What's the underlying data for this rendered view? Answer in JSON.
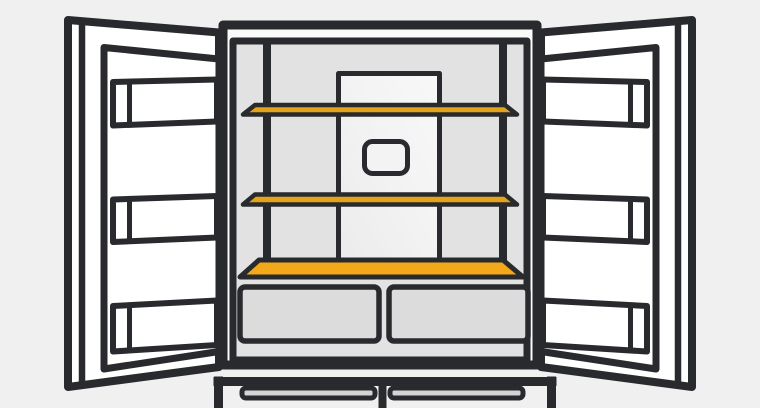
{
  "illustration": {
    "subject": "open-french-door-refrigerator",
    "style": "flat-line-art",
    "text": [],
    "highlighted_parts": [
      "upper-shelf",
      "middle-shelf",
      "bottom-deck"
    ],
    "colors": {
      "background": "#f0f0f1",
      "outline": "#292a2d",
      "door_white": "#ffffff",
      "cabinet_frame": "#fbfbfc",
      "interior_gray": "#e2e2e3",
      "panel_light_1": "#ebebec",
      "panel_light_2": "#f3f3f4",
      "panel_light_3": "#f8f8f9",
      "dispenser_fill": "#f3f3f4",
      "shelf_gold": "#e3a41c",
      "deck_orange": "#f2a818",
      "drawer_gray": "#dcdcdd",
      "handle_gray": "#d4d4d5"
    }
  }
}
